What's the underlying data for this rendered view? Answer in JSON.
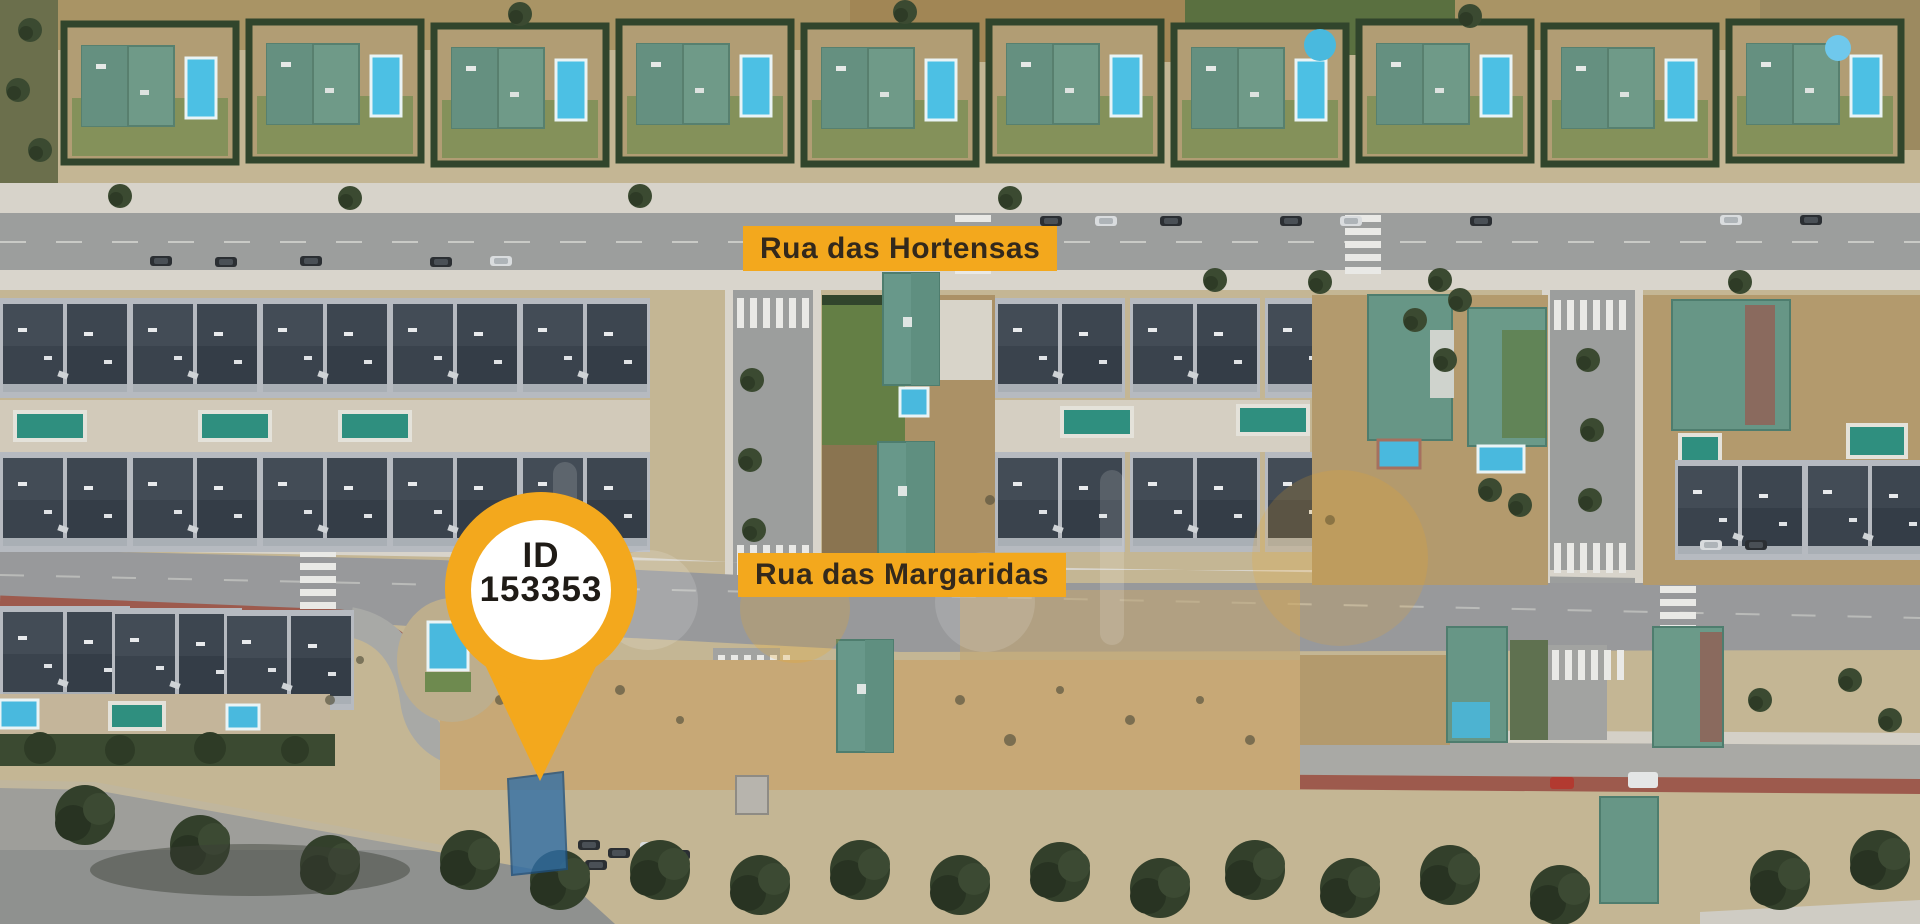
{
  "brand": {
    "accent_color": "#F3A81D",
    "label_text_color": "#33291C",
    "pin_text_color": "#1F1B16"
  },
  "map": {
    "type": "satellite-aerial-view",
    "street_labels": [
      {
        "name": "Rua das Hortensas"
      },
      {
        "name": "Rua das Margaridas"
      }
    ]
  },
  "pin": {
    "line1": "ID",
    "line2": "153353"
  },
  "parcel": {
    "color": "#2F6EA6"
  },
  "watermark": {
    "visible": true
  }
}
